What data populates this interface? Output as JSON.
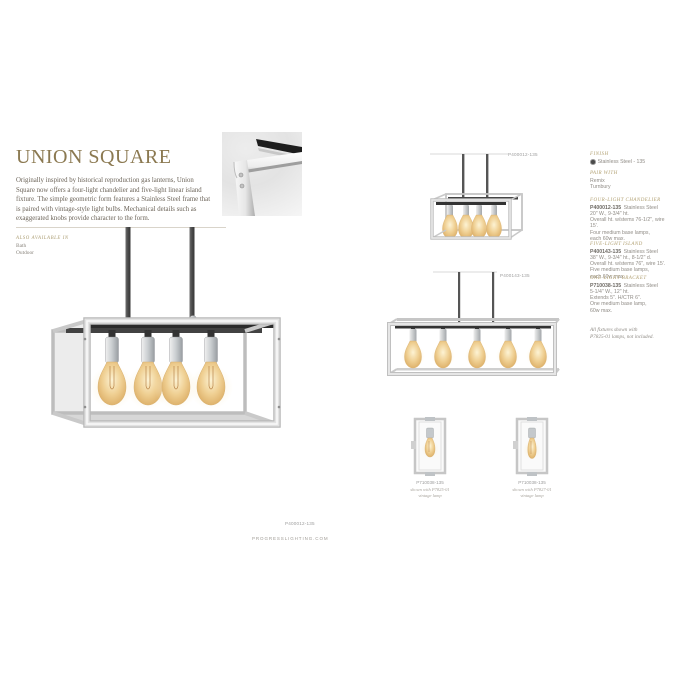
{
  "page": {
    "title": "UNION SQUARE",
    "intro": "Originally inspired by historical reproduction gas lanterns, Union Square now offers a four-light chandelier and five-light linear island fixture. The simple geometric form features a Stainless Steel frame that is paired with vintage-style light bulbs. Mechanical details such as exaggerated knobs provide character to the form.",
    "also_available_heading": "ALSO AVAILABLE IN",
    "also_available": [
      "Bath",
      "Outdoor"
    ],
    "website": "PROGRESSLIGHTING.COM"
  },
  "figures": {
    "main_chandelier": {
      "label": "P400012-135"
    },
    "small_chandelier": {
      "label": "P400012-135"
    },
    "island": {
      "label": "P400143-135"
    },
    "sconce_left": {
      "label": "P710038-135",
      "caption": [
        "shown with P7825-01",
        "vintage lamp"
      ]
    },
    "sconce_right": {
      "label": "P710038-135",
      "caption": [
        "shown with P7827-01",
        "vintage lamp"
      ]
    }
  },
  "specs": {
    "finish_heading": "FINISH",
    "finish_value": "Stainless Steel - 135",
    "pair_heading": "PAIR WITH",
    "pair_items": [
      "Remix",
      "Turnbury"
    ],
    "products": [
      {
        "heading": "FOUR-LIGHT CHANDELIER",
        "sku": "P400012-135",
        "finish": "Stainless Steel",
        "lines": [
          "20\" W., 9-3/4\" ht.",
          "Overall ht. w/stems 76-1/2\", wire 15'.",
          "Four medium base lamps,",
          "each 60w max."
        ]
      },
      {
        "heading": "FIVE-LIGHT ISLAND",
        "sku": "P400143-135",
        "finish": "Stainless Steel",
        "lines": [
          "38\" W., 9-3/4\" ht., 8-1/2\" d.",
          "Overall ht. w/stems 76\", wire 15'.",
          "Five medium base lamps,",
          "each 60w max."
        ]
      },
      {
        "heading": "ONE-LIGHT BRACKET",
        "sku": "P710038-135",
        "finish": "Stainless Steel",
        "lines": [
          "5-1/4\" W., 12\" ht.",
          "Extends 5\". H/CTR 6\".",
          "One medium base lamp,",
          "60w max."
        ]
      }
    ],
    "note": [
      "All fixtures shown with",
      "P7825-01 lamps, not included."
    ]
  },
  "colors": {
    "accent_gold": "#8b7951",
    "heading_gold": "#b2a173",
    "body_text": "#6c6459",
    "spec_text": "#908c86",
    "label_gray": "#9d9d9d",
    "steel": "#c9c9c9",
    "bulb_amber": "#eac684"
  }
}
